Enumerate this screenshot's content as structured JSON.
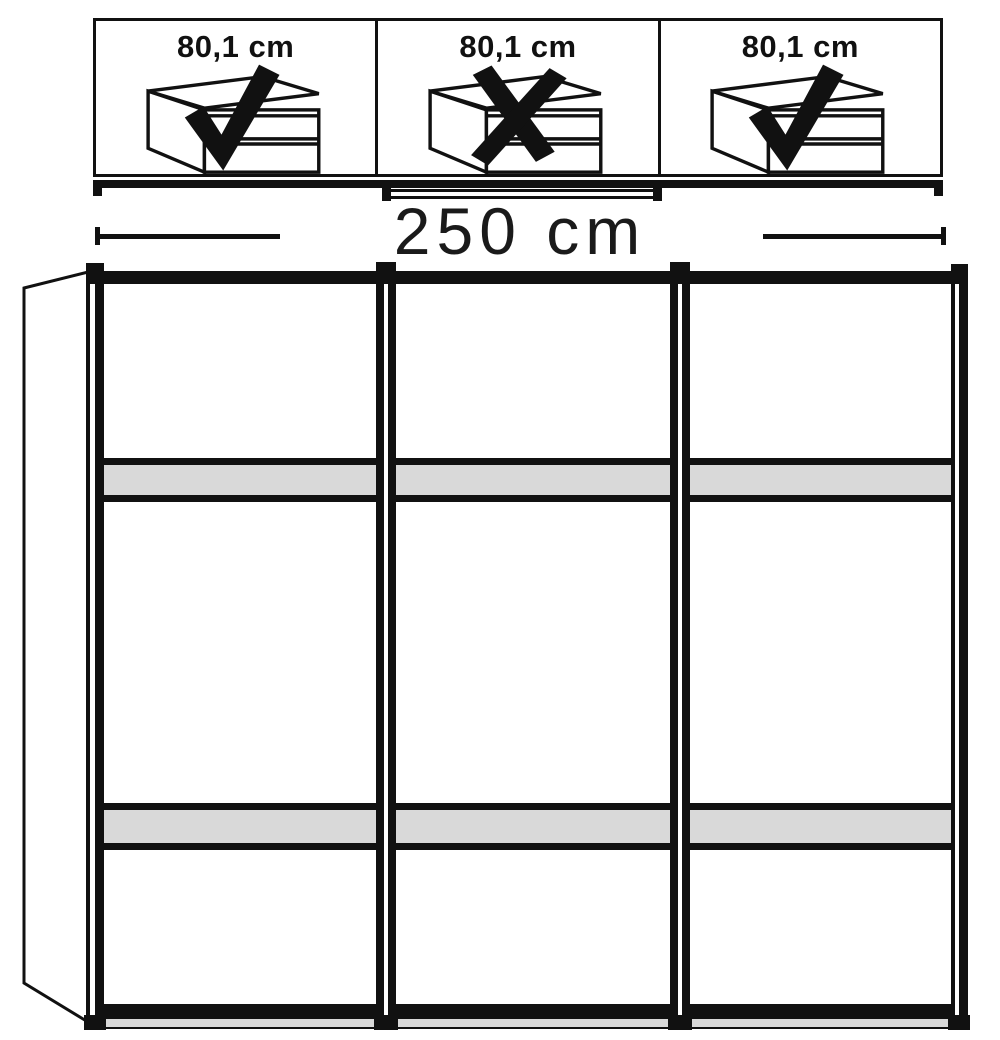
{
  "colors": {
    "line": "#111111",
    "crossbar_gray": "#d9d9d9",
    "background": "#ffffff"
  },
  "top_panels": [
    {
      "label": "80,1 cm",
      "mark": "check",
      "icon": "drawer-unit-icon"
    },
    {
      "label": "80,1 cm",
      "mark": "cross",
      "icon": "drawer-unit-icon"
    },
    {
      "label": "80,1 cm",
      "mark": "check",
      "icon": "drawer-unit-icon"
    }
  ],
  "dimension": {
    "label": "250 cm"
  },
  "wardrobe": {
    "door_count": 3,
    "crossbars_per_door": 2
  }
}
